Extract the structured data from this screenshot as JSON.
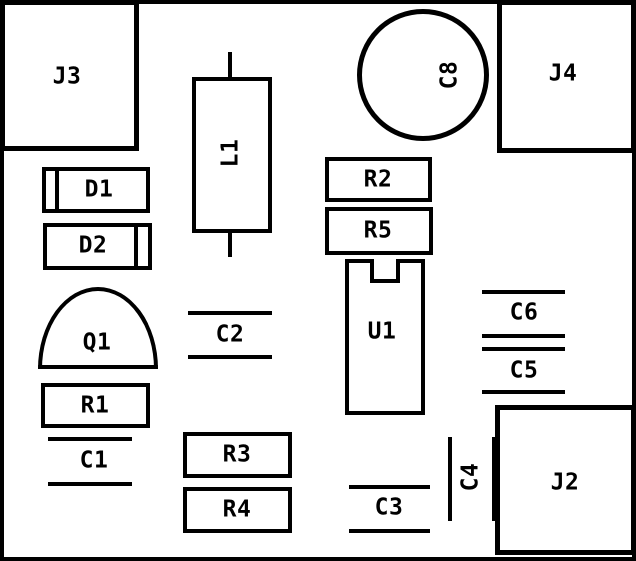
{
  "diagram": {
    "kind": "pcb-silkscreen-component-placement",
    "colors": {
      "line": "#000000",
      "background": "#ffffff"
    },
    "board": {
      "width": 636,
      "height": 561,
      "frame_border": 4
    },
    "components": [
      {
        "ref": "J3",
        "type": "box",
        "label": "J3",
        "rot": false,
        "x": 0,
        "y": 0,
        "w": 139,
        "h": 151,
        "bw": 5,
        "lx": 67,
        "ly": 77
      },
      {
        "ref": "J4",
        "type": "box",
        "label": "J4",
        "rot": false,
        "x": 497,
        "y": 0,
        "w": 139,
        "h": 153,
        "bw": 5,
        "lx": 563,
        "ly": 74
      },
      {
        "ref": "C8",
        "type": "circle",
        "label": "C8",
        "rot": true,
        "x": 357,
        "y": 9,
        "d": 132,
        "bw": 5,
        "lx": 450,
        "ly": 75
      },
      {
        "ref": "L1",
        "type": "inductor",
        "label": "L1",
        "rot": true,
        "x": 192,
        "y": 77,
        "w": 80,
        "h": 156,
        "bw": 4,
        "lead_x": 228,
        "lead_w": 4,
        "leads": [
          {
            "y1": 52,
            "y2": 79
          },
          {
            "y1": 231,
            "y2": 257
          }
        ],
        "lx": 231,
        "ly": 153
      },
      {
        "ref": "D1",
        "type": "diode",
        "label": "D1",
        "rot": false,
        "x": 42,
        "y": 167,
        "w": 108,
        "h": 46,
        "bw": 4,
        "divider_x": 55,
        "lx": 99,
        "ly": 190
      },
      {
        "ref": "D2",
        "type": "diode",
        "label": "D2",
        "rot": false,
        "x": 43,
        "y": 223,
        "w": 109,
        "h": 47,
        "bw": 4,
        "divider_x": 134,
        "lx": 93,
        "ly": 246
      },
      {
        "ref": "Q1",
        "type": "dome",
        "label": "Q1",
        "rot": false,
        "x": 38,
        "y": 287,
        "w": 120,
        "h": 82,
        "bw": 4,
        "lx": 97,
        "ly": 343
      },
      {
        "ref": "R1",
        "type": "box",
        "label": "R1",
        "rot": false,
        "x": 41,
        "y": 383,
        "w": 109,
        "h": 45,
        "bw": 4,
        "lx": 95,
        "ly": 406
      },
      {
        "ref": "C1",
        "type": "cap_h",
        "label": "C1",
        "rot": false,
        "x": 48,
        "w": 84,
        "y1": 437,
        "y2": 482,
        "t": 4,
        "lx": 94,
        "ly": 461
      },
      {
        "ref": "C2",
        "type": "cap_h",
        "label": "C2",
        "rot": false,
        "x": 188,
        "w": 84,
        "y1": 311,
        "y2": 355,
        "t": 4,
        "lx": 230,
        "ly": 335
      },
      {
        "ref": "R2",
        "type": "box",
        "label": "R2",
        "rot": false,
        "x": 325,
        "y": 157,
        "w": 107,
        "h": 45,
        "bw": 4,
        "lx": 378,
        "ly": 180
      },
      {
        "ref": "R5",
        "type": "box",
        "label": "R5",
        "rot": false,
        "x": 325,
        "y": 207,
        "w": 108,
        "h": 48,
        "bw": 4,
        "lx": 378,
        "ly": 231
      },
      {
        "ref": "U1",
        "type": "ic",
        "label": "U1",
        "rot": false,
        "x": 345,
        "y": 259,
        "w": 80,
        "h": 156,
        "bw": 4,
        "notch_x": 370,
        "notch_w": 30,
        "notch_d": 24,
        "lx": 382,
        "ly": 332
      },
      {
        "ref": "C6",
        "type": "cap_h",
        "label": "C6",
        "rot": false,
        "x": 482,
        "w": 83,
        "y1": 290,
        "y2": 334,
        "t": 4,
        "lx": 524,
        "ly": 313
      },
      {
        "ref": "C5",
        "type": "cap_h",
        "label": "C5",
        "rot": false,
        "x": 482,
        "w": 83,
        "y1": 347,
        "y2": 390,
        "t": 4,
        "lx": 524,
        "ly": 371
      },
      {
        "ref": "R3",
        "type": "box",
        "label": "R3",
        "rot": false,
        "x": 183,
        "y": 432,
        "w": 109,
        "h": 46,
        "bw": 4,
        "lx": 237,
        "ly": 455
      },
      {
        "ref": "R4",
        "type": "box",
        "label": "R4",
        "rot": false,
        "x": 183,
        "y": 487,
        "w": 109,
        "h": 46,
        "bw": 4,
        "lx": 237,
        "ly": 510
      },
      {
        "ref": "C3",
        "type": "cap_h",
        "label": "C3",
        "rot": false,
        "x": 349,
        "w": 81,
        "y1": 485,
        "y2": 529,
        "t": 4,
        "lx": 389,
        "ly": 508
      },
      {
        "ref": "C4",
        "type": "cap_v",
        "label": "C4",
        "rot": true,
        "y": 437,
        "h": 84,
        "x1": 448,
        "x2": 492,
        "t": 4,
        "lx": 471,
        "ly": 477
      },
      {
        "ref": "J2",
        "type": "box",
        "label": "J2",
        "rot": false,
        "x": 495,
        "y": 405,
        "w": 141,
        "h": 150,
        "bw": 5,
        "lx": 565,
        "ly": 483
      }
    ]
  }
}
